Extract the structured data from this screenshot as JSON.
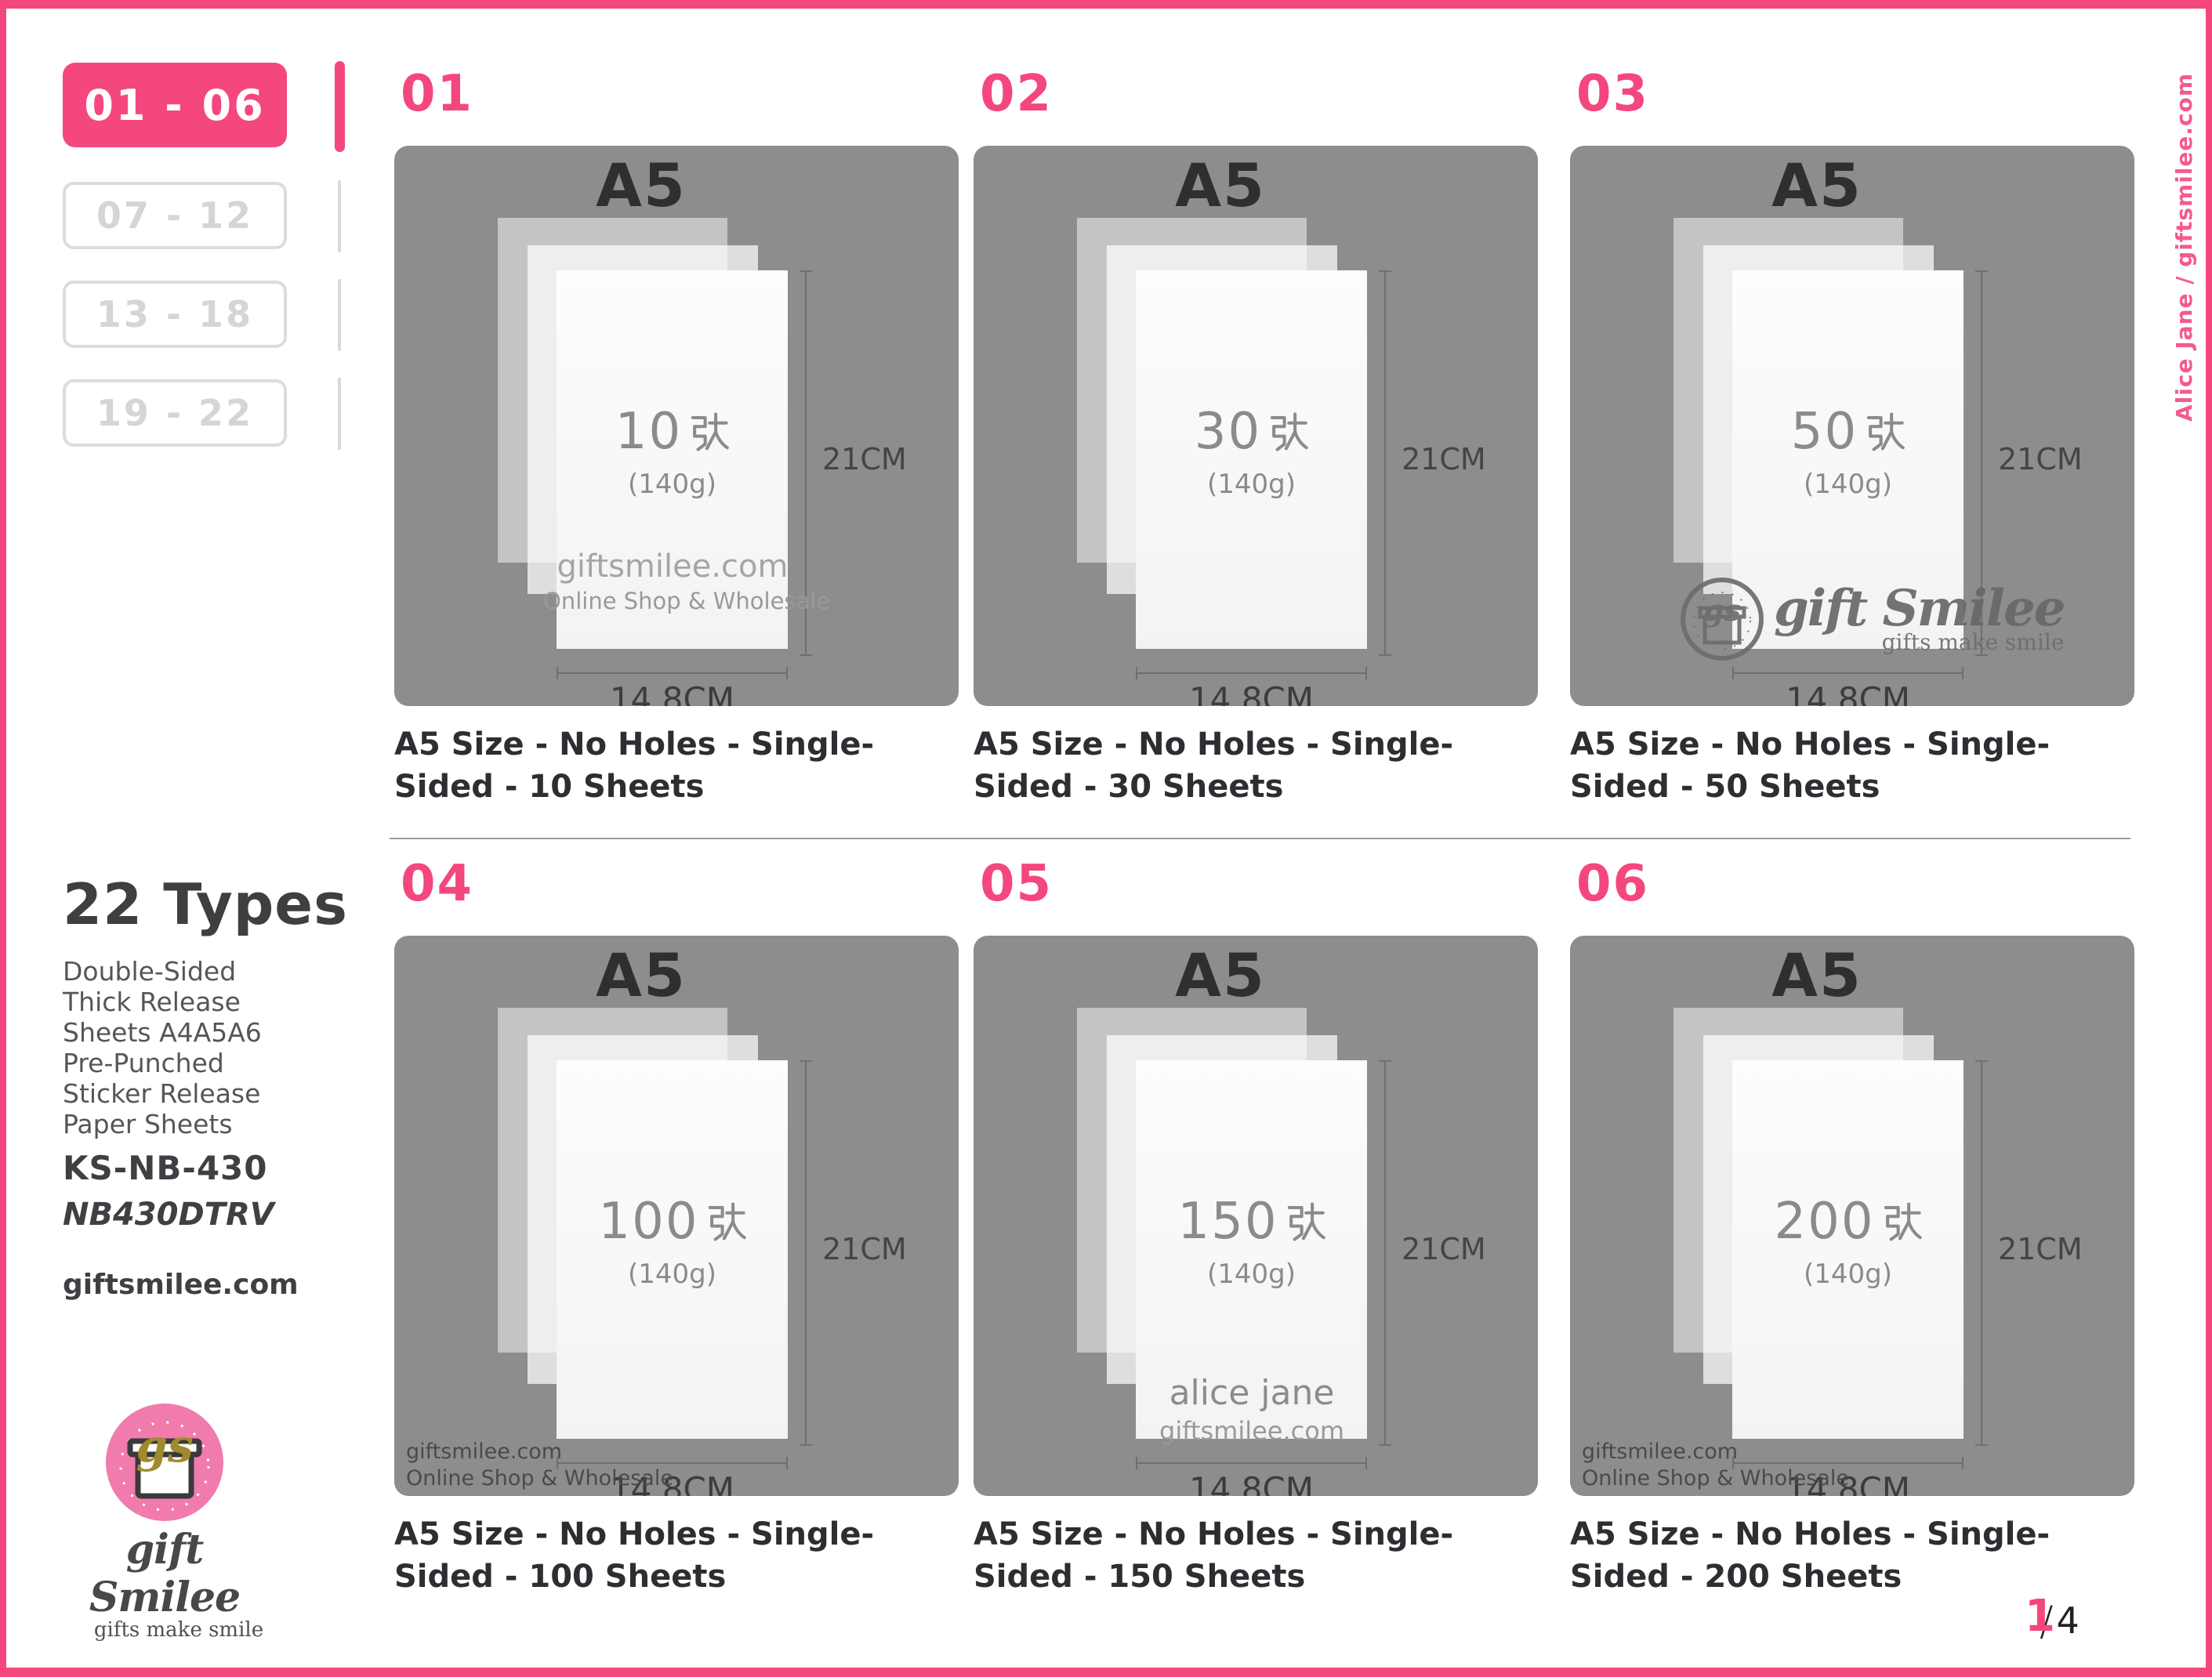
{
  "page": {
    "side_note": "Alice Jane / giftsmilee.com",
    "accent_pink": "#F4477E",
    "card_background": "#8E8C8C",
    "page_number": {
      "current": "1",
      "separator": "/",
      "total": "4"
    }
  },
  "sidebar": {
    "tabs": [
      {
        "label": "01 - 06",
        "active": true
      },
      {
        "label": "07 - 12",
        "active": false
      },
      {
        "label": "13 - 18",
        "active": false
      },
      {
        "label": "19 - 22",
        "active": false
      }
    ],
    "product": {
      "title": "22 Types",
      "description_lines": [
        "Double-Sided",
        "Thick Release",
        "Sheets A4A5A6",
        "Pre-Punched",
        "Sticker Release",
        "Paper Sheets"
      ],
      "model": "KS-NB-430",
      "sku": "NB430DTRV",
      "website": "giftsmilee.com"
    },
    "logo": {
      "monogram": "gs",
      "brand": "gift Smilee",
      "tagline": "gifts make smile"
    }
  },
  "cards": [
    {
      "number": "01",
      "size_label": "A5",
      "count": "10",
      "count_unit": "张",
      "weight": "(140g)",
      "height_label": "21CM",
      "width_label": "14.8CM",
      "caption": "A5 Size - No Holes - Single-Sided - 10 Sheets",
      "watermark": {
        "style": "on-paper",
        "line1": "giftsmilee.com",
        "line2": "Online Shop & Wholesale"
      }
    },
    {
      "number": "02",
      "size_label": "A5",
      "count": "30",
      "count_unit": "张",
      "weight": "(140g)",
      "height_label": "21CM",
      "width_label": "14.8CM",
      "caption": "A5 Size - No Holes - Single-Sided - 30 Sheets",
      "watermark": {
        "style": "none"
      }
    },
    {
      "number": "03",
      "size_label": "A5",
      "count": "50",
      "count_unit": "张",
      "weight": "(140g)",
      "height_label": "21CM",
      "width_label": "14.8CM",
      "caption": "A5 Size - No Holes - Single-Sided - 50 Sheets",
      "watermark": {
        "style": "brand-logo",
        "monogram": "gs",
        "brand": "gift Smilee",
        "tagline": "gifts make smile"
      }
    },
    {
      "number": "04",
      "size_label": "A5",
      "count": "100",
      "count_unit": "张",
      "weight": "(140g)",
      "height_label": "21CM",
      "width_label": "14.8CM",
      "caption": "A5 Size - No Holes - Single-Sided - 100 Sheets",
      "watermark": {
        "style": "corner",
        "line1": "giftsmilee.com",
        "line2": "Online Shop & Wholesale"
      }
    },
    {
      "number": "05",
      "size_label": "A5",
      "count": "150",
      "count_unit": "张",
      "weight": "(140g)",
      "height_label": "21CM",
      "width_label": "14.8CM",
      "caption": "A5 Size - No Holes - Single-Sided - 150 Sheets",
      "watermark": {
        "style": "on-paper",
        "line1": "alice jane",
        "line2": "giftsmilee.com"
      }
    },
    {
      "number": "06",
      "size_label": "A5",
      "count": "200",
      "count_unit": "张",
      "weight": "(140g)",
      "height_label": "21CM",
      "width_label": "14.8CM",
      "caption": "A5 Size - No Holes - Single-Sided - 200 Sheets",
      "watermark": {
        "style": "corner",
        "line1": "giftsmilee.com",
        "line2": "Online Shop & Wholesale"
      }
    }
  ]
}
